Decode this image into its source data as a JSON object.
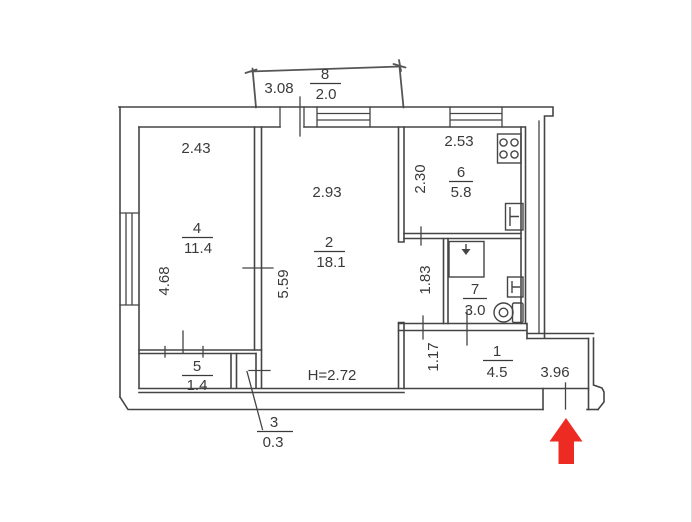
{
  "plan": {
    "height_note": "H=2.72",
    "rooms": [
      {
        "number": "1",
        "area": "4.5"
      },
      {
        "number": "2",
        "area": "18.1"
      },
      {
        "number": "3",
        "area": "0.3"
      },
      {
        "number": "4",
        "area": "11.4"
      },
      {
        "number": "5",
        "area": "1.4"
      },
      {
        "number": "6",
        "area": "5.8"
      },
      {
        "number": "7",
        "area": "3.0"
      },
      {
        "number": "8",
        "area": "2.0"
      }
    ],
    "dimensions": {
      "balcony_width": "3.08",
      "room4_width": "2.43",
      "room4_depth": "4.68",
      "room2_width": "2.93",
      "room2_depth": "5.59",
      "kitchen_width": "2.53",
      "kitchen_depth": "2.30",
      "corridor_depth": "1.83",
      "hall_depth": "1.17",
      "hall_width": "3.96"
    },
    "fixtures": [
      {
        "icon": "stove-icon"
      },
      {
        "icon": "kitchen-sink-icon"
      },
      {
        "icon": "shower-icon"
      },
      {
        "icon": "bathroom-sink-icon"
      },
      {
        "icon": "toilet-icon"
      }
    ],
    "annotations": {
      "entrance_arrow_color": "#ee2b22",
      "line_color": "#454545"
    }
  }
}
